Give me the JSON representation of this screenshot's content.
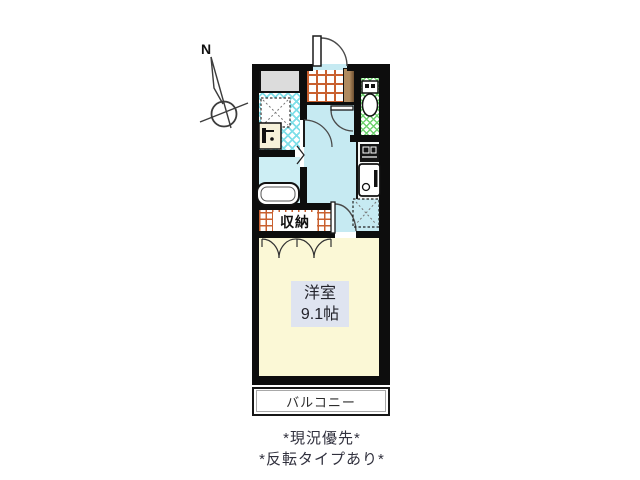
{
  "compass": {
    "north_label": "N"
  },
  "rooms": {
    "closet_label": "収納",
    "main_room_label": "洋室",
    "main_room_size": "9.1帖",
    "balcony_label": "バルコニー"
  },
  "fixtures": [
    "entrance-door",
    "shoe-cabinet",
    "toilet",
    "stove",
    "kitchen-sink",
    "refrigerator-space",
    "washing-machine-pan",
    "washbasin",
    "bathtub",
    "closet-folding-doors",
    "bathroom-folding-door"
  ],
  "notes": {
    "line1": "*現況優先*",
    "line2": "*反転タイプあり*"
  },
  "colors": {
    "wall": "#0d0d0d",
    "room-floor": "#fbf8d6",
    "corridor-floor": "#c6eaf2",
    "bath-floor": "#cdeef4",
    "lattice-cyan": "#7fdfe9",
    "lattice-green": "#6fd26f",
    "grid-orange": "#c9602f",
    "wood-light": "#b08b60",
    "wood-dark": "#6e4f30",
    "gray-box": "#dcdcdc",
    "label-bg": "#dfe4f0",
    "text": "#23232b"
  }
}
